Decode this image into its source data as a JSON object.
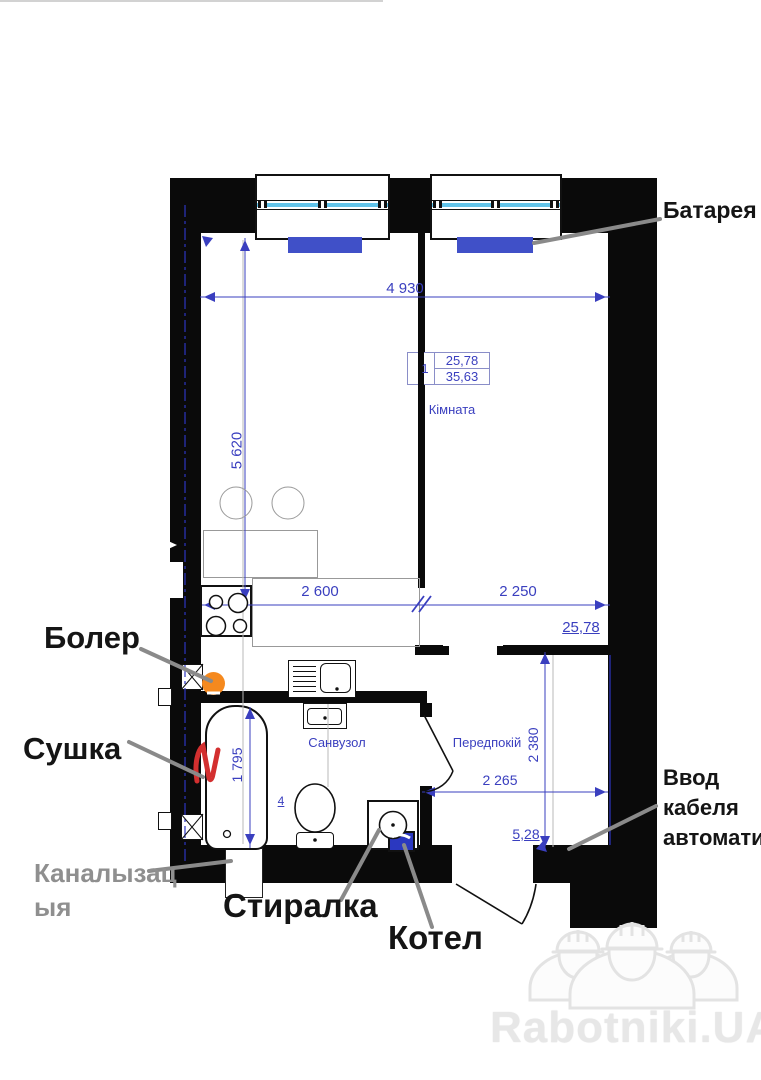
{
  "watermark": {
    "brand": "Rabotniki.UA"
  },
  "stamp": {
    "number": "1",
    "living_area": "25,78",
    "total_area": "35,63"
  },
  "rooms": {
    "main": "Кімната",
    "bathroom": "Санвузол",
    "hallway": "Передпокій"
  },
  "dims": {
    "top_width": "4 930",
    "left_height": "5 620",
    "kitchen_width": "2 600",
    "room_width": "2 250",
    "room_area": "25,78",
    "hallway_height": "2 380",
    "hallway_width": "2 265",
    "hallway_area": "5,28",
    "bath_length": "1 795",
    "door_width": "4"
  },
  "callouts": {
    "radiator": "Батарея",
    "boiler": "Болер",
    "dryer": "Сушка",
    "sewer_line1": "Каналызац",
    "sewer_line2": "ыя",
    "washer": "Стиралка",
    "heater": "Котел",
    "cable_line1": "Ввод",
    "cable_line2": "кабеля",
    "cable_line3": "автомати"
  },
  "colors": {
    "radiator_blue": "#4050c8",
    "boiler_orange": "#f5891e",
    "heater_blue": "#2b38c0",
    "dimension_blue": "#3a3fbf",
    "callout_gray": "#8f8f8f",
    "dryer_mark_red": "#d32f2f",
    "glazing_blue": "#62c4ea",
    "watermark_gray": "#e7e7e7"
  }
}
